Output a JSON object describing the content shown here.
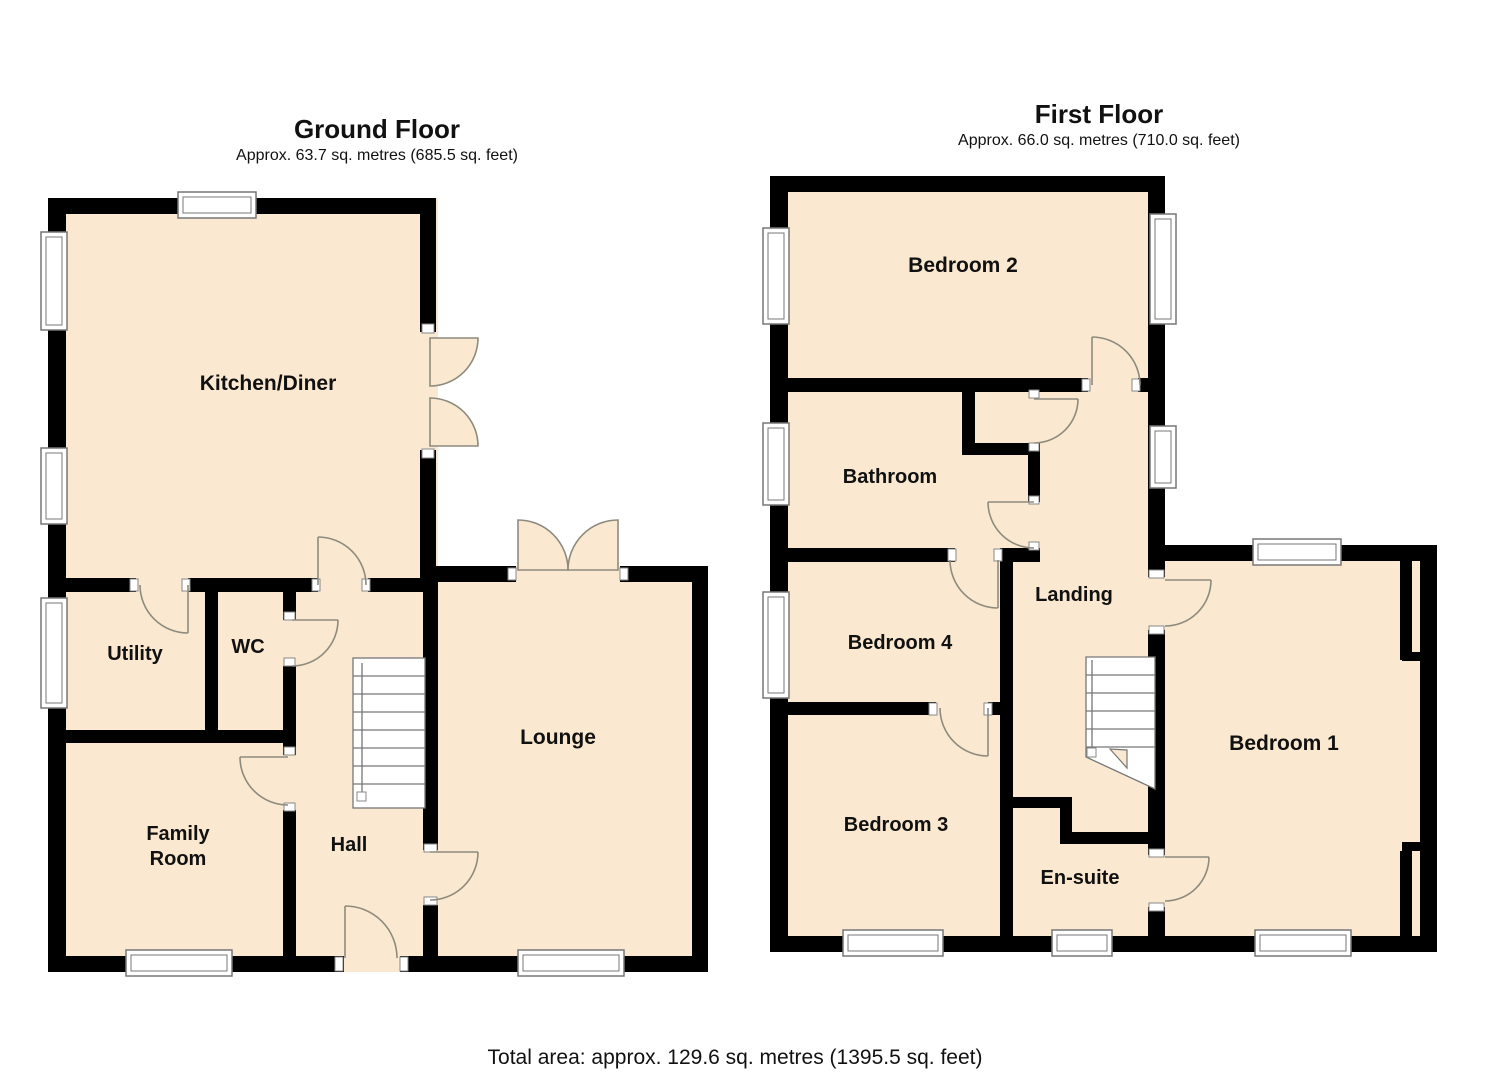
{
  "ground_floor": {
    "title": "Ground Floor",
    "area": "Approx. 63.7 sq. metres (685.5 sq. feet)",
    "rooms": {
      "kitchen": "Kitchen/Diner",
      "utility": "Utility",
      "wc": "WC",
      "family_line1": "Family",
      "family_line2": "Room",
      "hall": "Hall",
      "lounge": "Lounge"
    }
  },
  "first_floor": {
    "title": "First Floor",
    "area": "Approx. 66.0 sq. metres (710.0 sq. feet)",
    "rooms": {
      "bedroom2": "Bedroom 2",
      "bathroom": "Bathroom",
      "landing": "Landing",
      "bedroom4": "Bedroom 4",
      "bedroom1": "Bedroom 1",
      "bedroom3": "Bedroom 3",
      "ensuite": "En-suite"
    }
  },
  "footer": {
    "total_area": "Total area: approx. 129.6 sq. metres (1395.5 sq. feet)"
  },
  "colors": {
    "room_fill": "#FAE9D0",
    "wall": "#000000",
    "door_arc": "#8E8B7E",
    "window_frame": "#777777",
    "text": "#111111"
  }
}
